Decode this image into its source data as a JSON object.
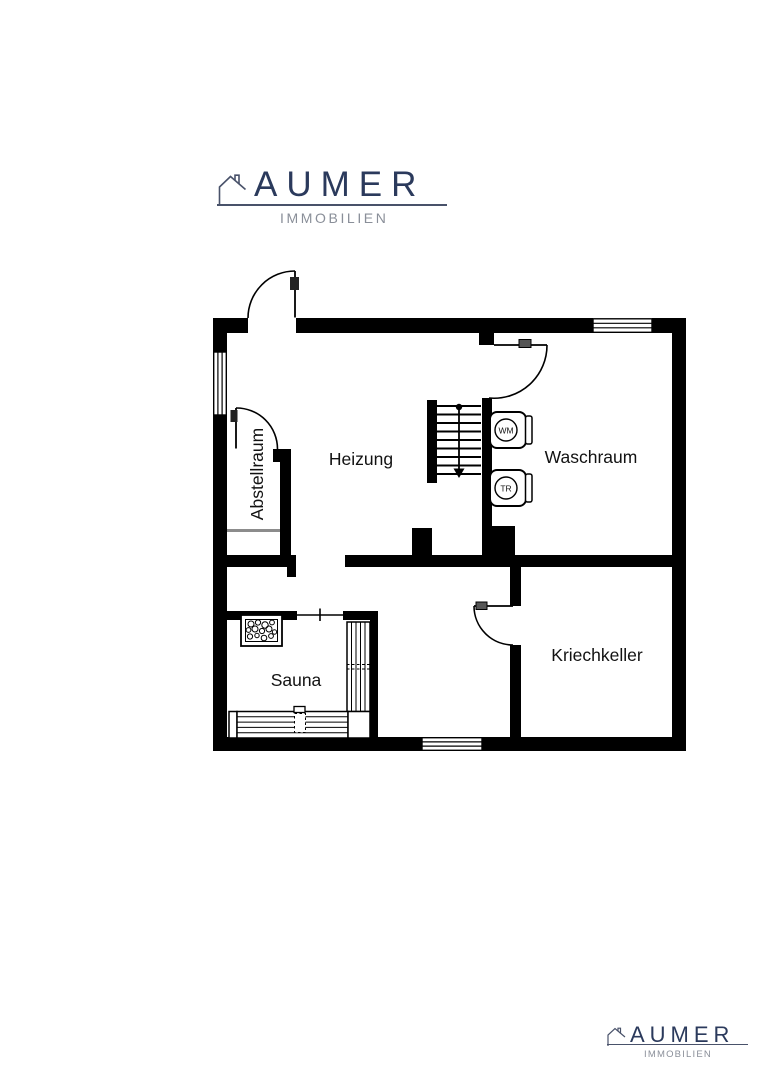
{
  "brand": {
    "name": "AUMER",
    "subtitle": "IMMOBILIEN",
    "navy": "#2b3a5c",
    "gray": "#8a8f99"
  },
  "floorplan": {
    "rooms": [
      {
        "label": "Heizung"
      },
      {
        "label": "Waschraum"
      },
      {
        "label": "Abstellraum"
      },
      {
        "label": "Sauna"
      },
      {
        "label": "Kriechkeller"
      }
    ],
    "appliances": [
      {
        "label": "WM"
      },
      {
        "label": "TR"
      }
    ],
    "wall_color": "#000000"
  }
}
